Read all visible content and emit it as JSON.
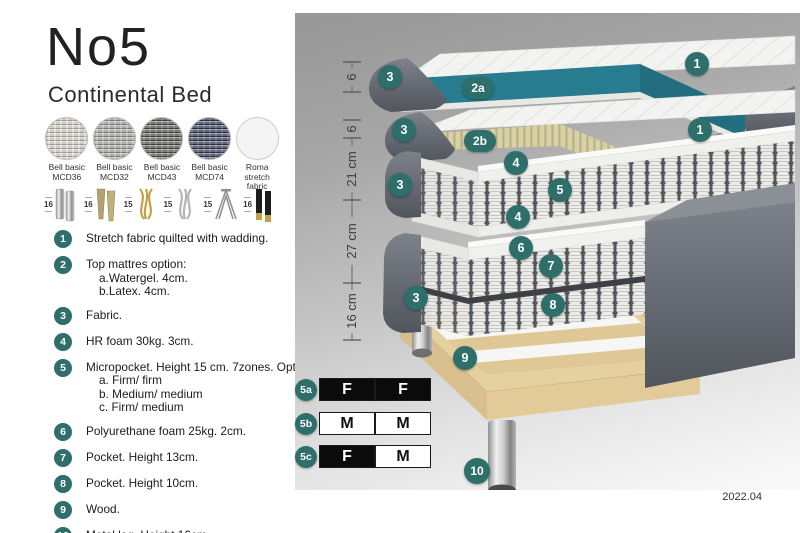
{
  "title": "No5",
  "subtitle": "Continental Bed",
  "fabrics": [
    {
      "line1": "Bell basic",
      "line2": "MCD36",
      "color": "#d8d4ca"
    },
    {
      "line1": "Bell basic",
      "line2": "MCD32",
      "color": "#a7a6a2"
    },
    {
      "line1": "Bell basic",
      "line2": "MCD43",
      "color": "#55554f"
    },
    {
      "line1": "Bell basic",
      "line2": "MCD74",
      "color": "#333a55"
    },
    {
      "line1": "Roma",
      "line2": "stretch fabric",
      "color": "#f4f4f4"
    }
  ],
  "legs": [
    {
      "height": "16",
      "type": "chrome-cylinder"
    },
    {
      "height": "16",
      "type": "square-taper-brass"
    },
    {
      "height": "15",
      "type": "gold-curved"
    },
    {
      "height": "15",
      "type": "silver-curved"
    },
    {
      "height": "15",
      "type": "hairpin-metal"
    },
    {
      "height": "16",
      "type": "black-gold-cylinder"
    }
  ],
  "features": [
    {
      "num": "1",
      "text": "Stretch fabric quilted with wadding.",
      "sub": []
    },
    {
      "num": "2",
      "text": "Top mattres option:",
      "sub": [
        "a.Watergel. 4cm.",
        "b.Latex. 4cm."
      ]
    },
    {
      "num": "3",
      "text": "Fabric.",
      "sub": []
    },
    {
      "num": "4",
      "text": "HR foam 30kg. 3cm.",
      "sub": []
    },
    {
      "num": "5",
      "text": "Micropocket. Height 15 cm. 7zones. Option:",
      "sub": [
        "a. Firm/ firm",
        "b. Medium/ medium",
        "c. Firm/ medium"
      ]
    },
    {
      "num": "6",
      "text": "Polyurethane foam 25kg. 2cm.",
      "sub": []
    },
    {
      "num": "7",
      "text": "Pocket. Height 13cm.",
      "sub": []
    },
    {
      "num": "8",
      "text": "Pocket. Height 10cm.",
      "sub": []
    },
    {
      "num": "9",
      "text": "Wood.",
      "sub": []
    },
    {
      "num": "10",
      "text": "Metal leg. Height 16cm.",
      "sub": []
    }
  ],
  "diagram": {
    "dimensions": [
      "6",
      "6",
      "21 cm",
      "27 cm",
      "16 cm"
    ],
    "badges": [
      "3",
      "2a",
      "1",
      "3",
      "2b",
      "1",
      "4",
      "5",
      "4",
      "3",
      "6",
      "7",
      "8",
      "3",
      "9",
      "10"
    ],
    "firmness": [
      {
        "label": "5a",
        "cells": [
          {
            "value": "F",
            "style": "dark"
          },
          {
            "value": "F",
            "style": "dark"
          }
        ]
      },
      {
        "label": "5b",
        "cells": [
          {
            "value": "M",
            "style": "light"
          },
          {
            "value": "M",
            "style": "light"
          }
        ]
      },
      {
        "label": "5c",
        "cells": [
          {
            "value": "F",
            "style": "dark"
          },
          {
            "value": "M",
            "style": "light"
          }
        ]
      }
    ],
    "version": "2022.04"
  },
  "colors": {
    "badge_teal": "#2e6f6c",
    "layer_teal": "#287c90",
    "fabric_gray": "#666b73",
    "latex_beige": "#d9d2a9",
    "wood": "#e5d0a0"
  }
}
